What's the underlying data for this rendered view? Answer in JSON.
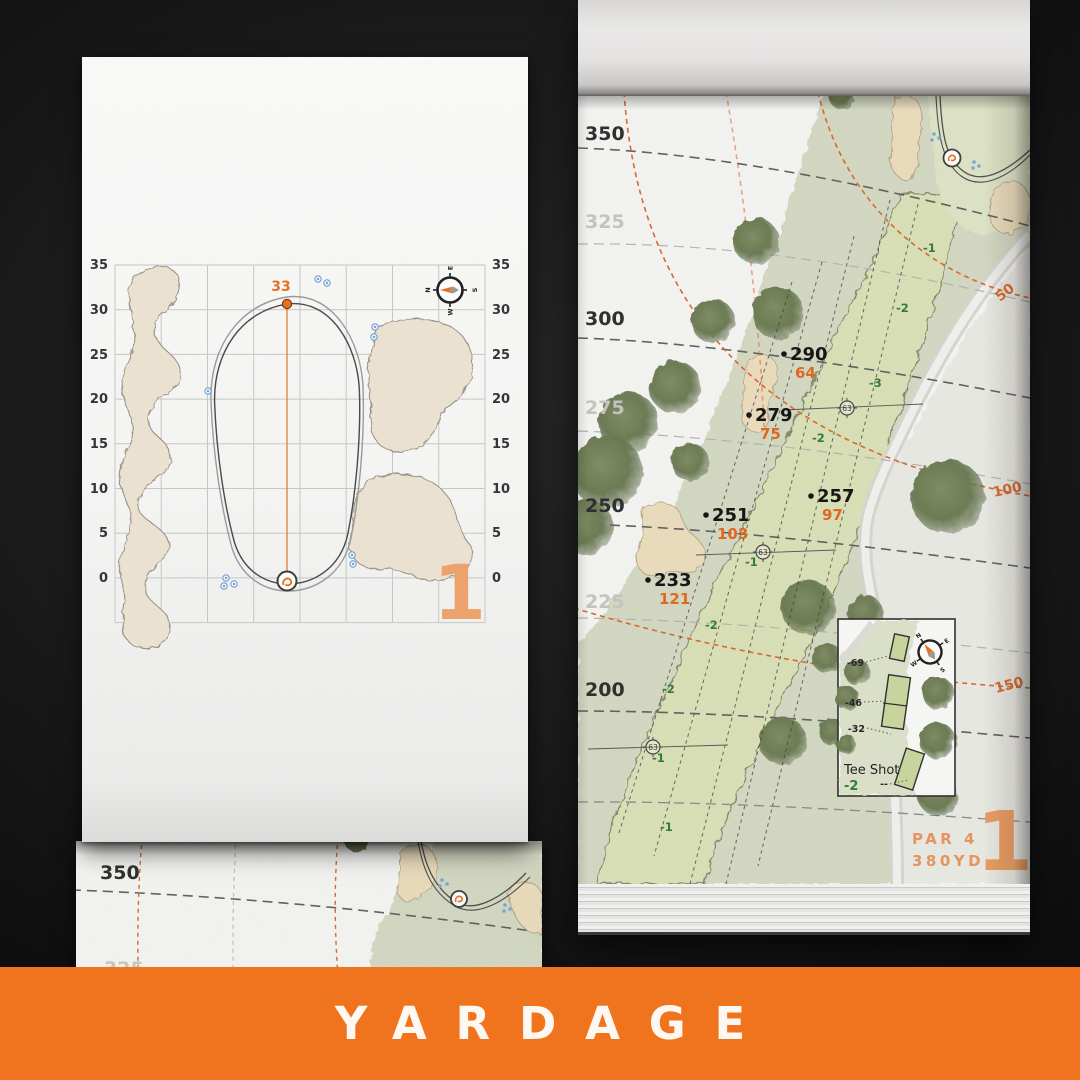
{
  "colors": {
    "accent": "#E8701E",
    "accent_soft": "#ECA06A",
    "banner": "#F0741E"
  },
  "banner": {
    "title": "YARDAGE"
  },
  "left_page": {
    "axis": [
      "35",
      "30",
      "25",
      "20",
      "15",
      "10",
      "5",
      "0"
    ],
    "pin_distance": "33",
    "hole_number": "1",
    "compass": {
      "n": "N",
      "e": "E",
      "s": "S",
      "w": "W"
    }
  },
  "under_page": {
    "d350": "350",
    "d325": "325"
  },
  "right_page": {
    "distances": [
      {
        "t": "350"
      },
      {
        "t": "325"
      },
      {
        "t": "300"
      },
      {
        "t": "275"
      },
      {
        "t": "250"
      },
      {
        "t": "225"
      },
      {
        "t": "200"
      }
    ],
    "arc_labels": [
      "50",
      "100",
      "150"
    ],
    "points": [
      {
        "dist": "290",
        "carry": "64"
      },
      {
        "dist": "279",
        "carry": "75"
      },
      {
        "dist": "257",
        "carry": "97"
      },
      {
        "dist": "251",
        "carry": "103"
      },
      {
        "dist": "233",
        "carry": "121"
      }
    ],
    "slopes": [
      "-1",
      "-2",
      "-3",
      "-2",
      "-1",
      "-2",
      "-2",
      "-1",
      "-1"
    ],
    "sprinkler_ids": [
      "63",
      "63",
      "63"
    ],
    "inset": {
      "title": "Tee Shot",
      "slope": "-2",
      "offsets": [
        "-69",
        "-46",
        "-32"
      ],
      "dash": "--"
    },
    "compass": {
      "n": "N",
      "e": "E",
      "s": "S",
      "w": "W"
    },
    "par_label": "PAR 4",
    "distance_label": "380YD",
    "hole_number": "1"
  }
}
